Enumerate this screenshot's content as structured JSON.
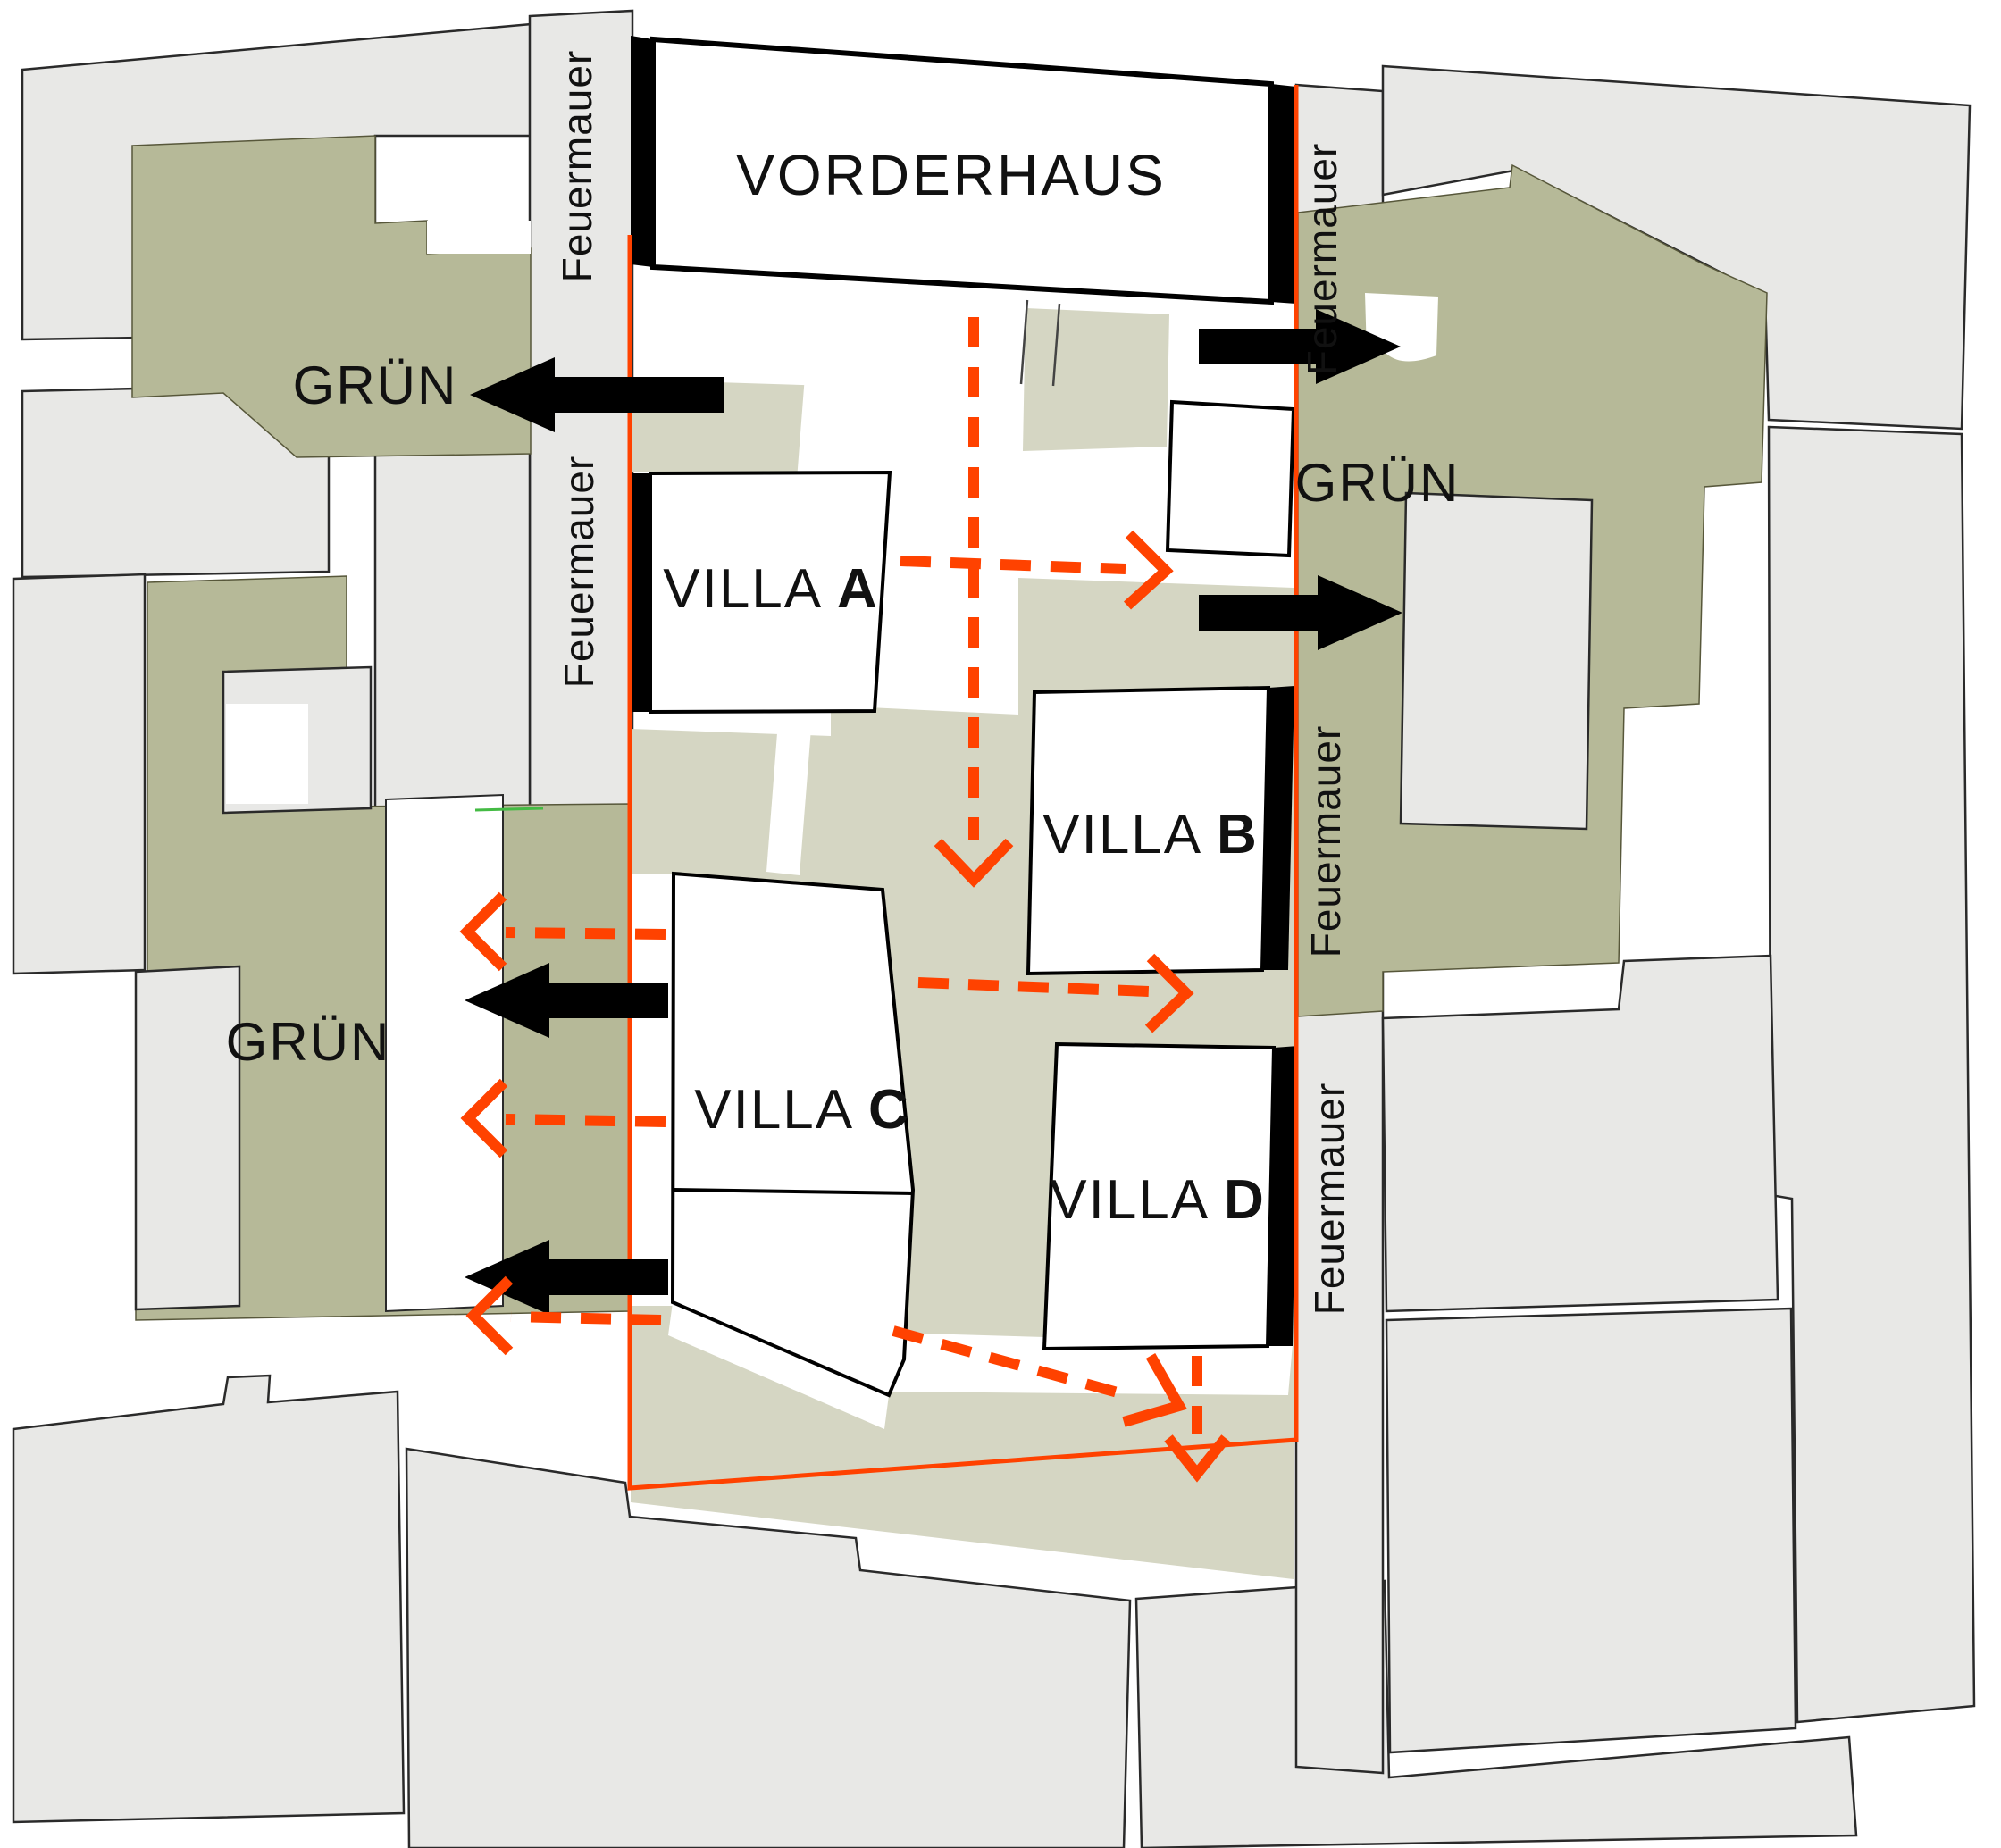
{
  "plan": {
    "type": "architectural-site-plan",
    "labels": {
      "vorderhaus": "VORDERHAUS",
      "villa_prefix": "VILLA ",
      "villa_a": "A",
      "villa_b": "B",
      "villa_c": "C",
      "villa_d": "D",
      "gruen": "GRÜN",
      "feuermauer": "Feuermauer"
    },
    "annotations": {
      "gruen_labels_count": 3,
      "feuermauer_labels_count": 5,
      "black_exit_arrows": [
        "left-top",
        "left-middle",
        "left-bottom",
        "right-top",
        "right-middle"
      ],
      "orange_dashed_arrows": [
        "center-down",
        "villa-a-to-right",
        "left-1",
        "left-2",
        "left-3",
        "villa-c-to-right",
        "diagonal-down-right",
        "villa-d-down"
      ]
    },
    "colors": {
      "boundary_orange": "#ff4200",
      "arrow_orange": "#ff4200",
      "green_dark": "#b6b998",
      "green_light": "#d5d6c3",
      "parcel_gray": "#e8e8e6",
      "building_white": "#ffffff",
      "firewall_black": "#000000"
    }
  }
}
